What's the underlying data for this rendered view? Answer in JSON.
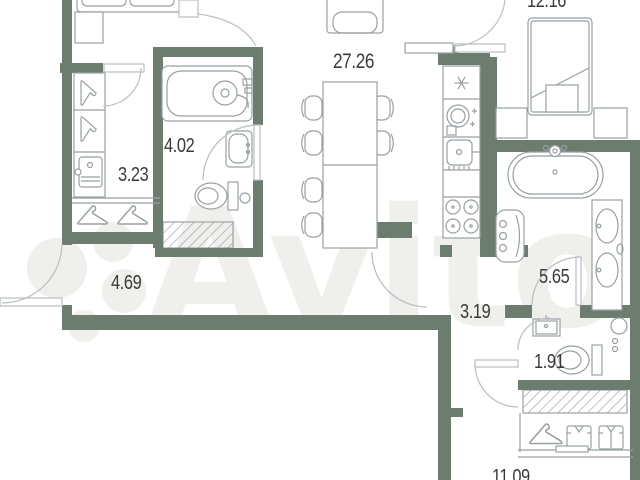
{
  "watermark": {
    "text": "Avito"
  },
  "plan": {
    "type": "apartment-floor-plan",
    "rooms": [
      {
        "id": "living-kitchen",
        "area_label": "27.26",
        "furniture": [
          "dining-table",
          "chairs",
          "armchair",
          "fridge",
          "cooktop",
          "kitchen-sink",
          "stove"
        ]
      },
      {
        "id": "bedroom",
        "area_label": "12.16",
        "furniture": [
          "double-bed",
          "nightstand",
          "nightstand"
        ]
      },
      {
        "id": "bathroom",
        "area_label": "4.02",
        "furniture": [
          "bathtub",
          "shower-head",
          "washbasin",
          "toilet",
          "vent-shaft"
        ]
      },
      {
        "id": "wardrobe-hall",
        "area_label": "3.23",
        "furniture": [
          "hanger",
          "hanger",
          "drawer-unit",
          "hanger",
          "hanger"
        ]
      },
      {
        "id": "hallway",
        "area_label": "4.69",
        "furniture": []
      },
      {
        "id": "corridor",
        "area_label": "3.19",
        "furniture": []
      },
      {
        "id": "bathroom-2",
        "area_label": "5.65",
        "furniture": [
          "freestanding-bathtub",
          "washing-machine",
          "double-washbasin"
        ]
      },
      {
        "id": "wc",
        "area_label": "1.91",
        "furniture": [
          "washbasin",
          "toilet",
          "paper-holder"
        ]
      },
      {
        "id": "room-2",
        "area_label": "11.09",
        "furniture": [
          "hanger",
          "shirt",
          "shirt",
          "vent-shaft"
        ]
      }
    ],
    "colors": {
      "wall": "#6c7d6f",
      "furniture_stroke": "#98a0a3",
      "door_arc": "#bcc2c4",
      "label": "#3a3a3a",
      "watermark": "#efefec",
      "background": "#ffffff"
    }
  }
}
